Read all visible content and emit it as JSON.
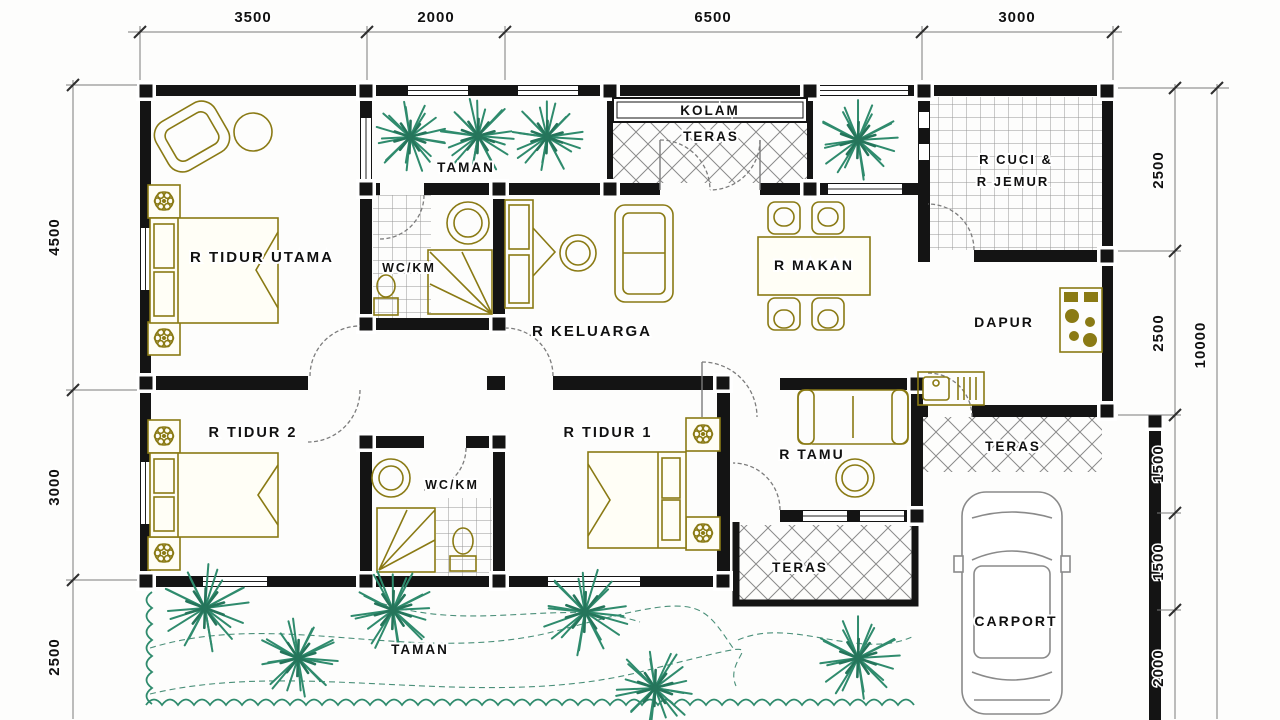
{
  "plan": {
    "type": "house-floor-plan",
    "rooms": {
      "r_tidur_utama": "R TIDUR UTAMA",
      "taman_top": "TAMAN",
      "wc_km_1": "WC/KM",
      "kolam": "KOLAM",
      "teras_front": "TERAS",
      "r_cuci_line1": "R CUCI &",
      "r_cuci_line2": "R JEMUR",
      "r_keluarga": "R KELUARGA",
      "r_makan": "R MAKAN",
      "dapur": "DAPUR",
      "teras_side": "TERAS",
      "r_tidur_2": "R TIDUR 2",
      "r_tidur_1": "R TIDUR 1",
      "wc_km_2": "WC/KM",
      "r_tamu": "R TAMU",
      "teras_back": "TERAS",
      "carport": "CARPORT",
      "taman_bottom": "TAMAN"
    },
    "dimensions": {
      "top": [
        "3500",
        "2000",
        "6500",
        "3000"
      ],
      "left": [
        "4500",
        "3000",
        "2500"
      ],
      "right": [
        "2500",
        "2500",
        "1500",
        "1500",
        "2000"
      ],
      "overall_height": "10000"
    },
    "colors": {
      "wall": "#141414",
      "furniture": "#8a7a14",
      "tree": "#2f8b6d",
      "tile_line": "#969696",
      "dim_line": "#7a7a7a",
      "text": "#111111"
    }
  }
}
